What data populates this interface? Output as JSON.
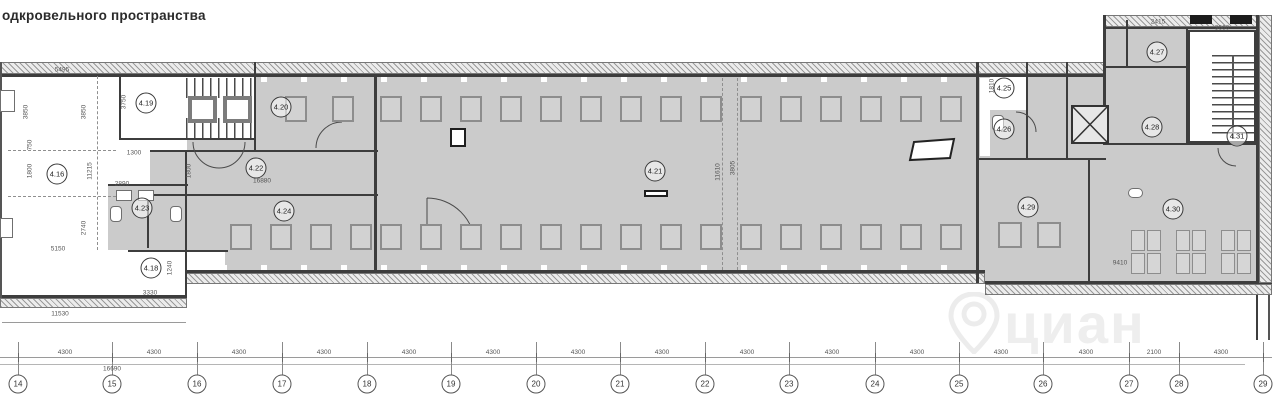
{
  "title": "одкровельного пространства",
  "watermark": {
    "text": "циан",
    "icon": "map-pin-icon"
  },
  "room_labels": [
    {
      "id": "4.16",
      "x": 57,
      "y": 174
    },
    {
      "id": "4.19",
      "x": 146,
      "y": 103
    },
    {
      "id": "4.20",
      "x": 281,
      "y": 107
    },
    {
      "id": "4.22",
      "x": 256,
      "y": 168
    },
    {
      "id": "4.23",
      "x": 142,
      "y": 208
    },
    {
      "id": "4.18",
      "x": 151,
      "y": 268
    },
    {
      "id": "4.24",
      "x": 284,
      "y": 211
    },
    {
      "id": "4.21",
      "x": 655,
      "y": 171
    },
    {
      "id": "4.25",
      "x": 1004,
      "y": 88
    },
    {
      "id": "4.26",
      "x": 1004,
      "y": 129
    },
    {
      "id": "4.29",
      "x": 1028,
      "y": 207
    },
    {
      "id": "4.27",
      "x": 1157,
      "y": 52
    },
    {
      "id": "4.28",
      "x": 1152,
      "y": 127
    },
    {
      "id": "4.31",
      "x": 1237,
      "y": 136
    },
    {
      "id": "4.30",
      "x": 1173,
      "y": 209
    }
  ],
  "grid": {
    "columns": [
      {
        "label": "14",
        "x": 18
      },
      {
        "label": "15",
        "x": 112
      },
      {
        "label": "16",
        "x": 197
      },
      {
        "label": "17",
        "x": 282
      },
      {
        "label": "18",
        "x": 367
      },
      {
        "label": "19",
        "x": 451
      },
      {
        "label": "20",
        "x": 536
      },
      {
        "label": "21",
        "x": 620
      },
      {
        "label": "22",
        "x": 705
      },
      {
        "label": "23",
        "x": 789
      },
      {
        "label": "24",
        "x": 875
      },
      {
        "label": "25",
        "x": 959
      },
      {
        "label": "26",
        "x": 1043
      },
      {
        "label": "27",
        "x": 1129
      },
      {
        "label": "28",
        "x": 1179
      },
      {
        "label": "29",
        "x": 1263
      }
    ],
    "spacings": [
      {
        "text": "4300",
        "x": 65
      },
      {
        "text": "4300",
        "x": 154
      },
      {
        "text": "4300",
        "x": 239
      },
      {
        "text": "4300",
        "x": 324
      },
      {
        "text": "4300",
        "x": 409
      },
      {
        "text": "4300",
        "x": 493
      },
      {
        "text": "4300",
        "x": 578
      },
      {
        "text": "4300",
        "x": 662
      },
      {
        "text": "4300",
        "x": 747
      },
      {
        "text": "4300",
        "x": 832
      },
      {
        "text": "4300",
        "x": 917
      },
      {
        "text": "4300",
        "x": 1001
      },
      {
        "text": "4300",
        "x": 1086
      },
      {
        "text": "2100",
        "x": 1154
      },
      {
        "text": "4300",
        "x": 1221
      }
    ],
    "total_label": {
      "text": "16690",
      "x": 112,
      "y": 369
    }
  },
  "dimensions": [
    {
      "t": "5495",
      "x": 62,
      "y": 70,
      "r": 0
    },
    {
      "t": "3850",
      "x": 26,
      "y": 112,
      "r": 1
    },
    {
      "t": "3850",
      "x": 84,
      "y": 112,
      "r": 1
    },
    {
      "t": "3750",
      "x": 124,
      "y": 102,
      "r": 1
    },
    {
      "t": "750",
      "x": 30,
      "y": 145,
      "r": 1
    },
    {
      "t": "1800",
      "x": 30,
      "y": 171,
      "r": 1
    },
    {
      "t": "11215",
      "x": 90,
      "y": 171,
      "r": 1
    },
    {
      "t": "1800",
      "x": 189,
      "y": 171,
      "r": 1
    },
    {
      "t": "1300",
      "x": 134,
      "y": 153,
      "r": 0
    },
    {
      "t": "2890",
      "x": 122,
      "y": 184,
      "r": 0
    },
    {
      "t": "2740",
      "x": 84,
      "y": 228,
      "r": 1
    },
    {
      "t": "5150",
      "x": 58,
      "y": 249,
      "r": 0
    },
    {
      "t": "11530",
      "x": 60,
      "y": 314,
      "r": 0
    },
    {
      "t": "3330",
      "x": 150,
      "y": 293,
      "r": 0
    },
    {
      "t": "1240",
      "x": 170,
      "y": 268,
      "r": 1
    },
    {
      "t": "16880",
      "x": 262,
      "y": 181,
      "r": 0
    },
    {
      "t": "11610",
      "x": 718,
      "y": 172,
      "r": 1
    },
    {
      "t": "3805",
      "x": 733,
      "y": 168,
      "r": 1
    },
    {
      "t": "1810",
      "x": 992,
      "y": 86,
      "r": 1
    },
    {
      "t": "9410",
      "x": 1120,
      "y": 263,
      "r": 0
    },
    {
      "t": "2415",
      "x": 1158,
      "y": 22,
      "r": 0
    },
    {
      "t": "3660",
      "x": 1222,
      "y": 28,
      "r": 0
    }
  ],
  "skylight_rows": [
    {
      "x": 285,
      "y": 96,
      "count": 2,
      "step": 47,
      "w": 22,
      "h": 26
    },
    {
      "x": 380,
      "y": 96,
      "count": 15,
      "step": 40,
      "w": 22,
      "h": 26
    },
    {
      "x": 230,
      "y": 224,
      "count": 4,
      "step": 40,
      "w": 22,
      "h": 26
    },
    {
      "x": 380,
      "y": 224,
      "count": 15,
      "step": 40,
      "w": 22,
      "h": 26
    },
    {
      "x": 998,
      "y": 222,
      "count": 2,
      "step": 39,
      "w": 24,
      "h": 26
    }
  ],
  "skylight_groups": {
    "xs": [
      1131,
      1176,
      1221
    ],
    "y": 230,
    "cell_w": 14,
    "cell_h": 21,
    "gap": 2,
    "rows": 2,
    "cols": 2
  }
}
